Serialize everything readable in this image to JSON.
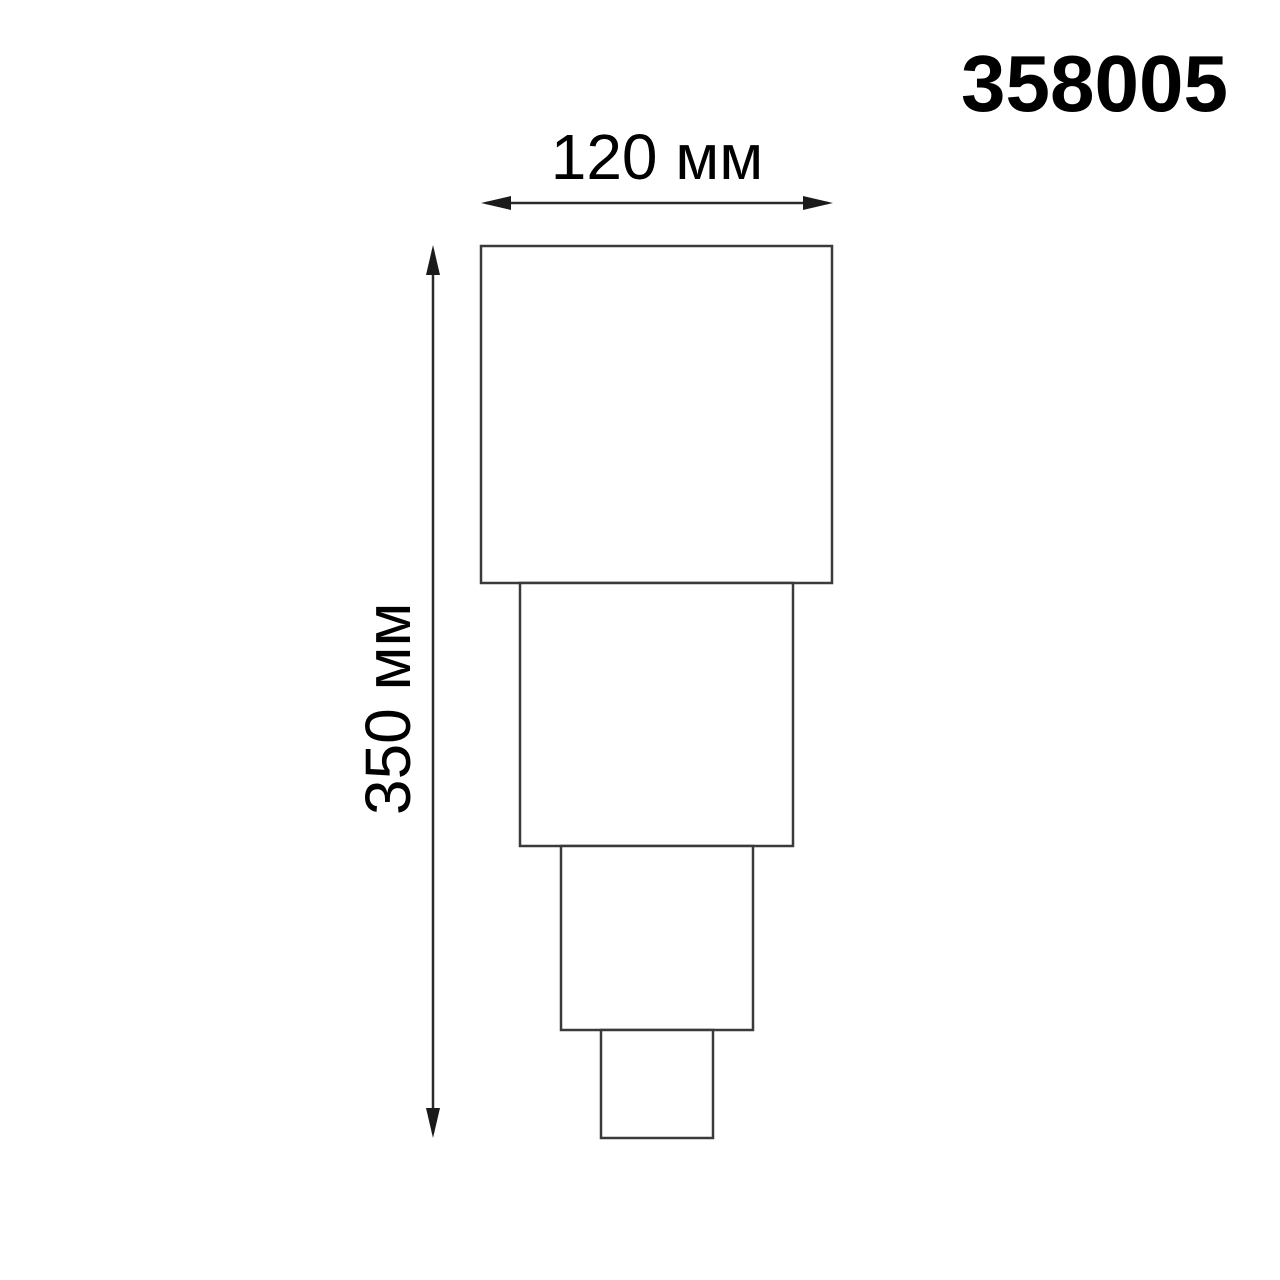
{
  "header": {
    "product_code": "358005"
  },
  "dimension_labels": {
    "width": "120 мм",
    "height": "350 мм"
  },
  "figure": {
    "type": "stepped-fixture-outline",
    "tiers": 4,
    "width_mm": 120,
    "height_mm": 350
  },
  "colors": {
    "background": "#ffffff",
    "outline": "#3a3a3a",
    "dimension_line": "#2a2a2a",
    "text": "#000000"
  }
}
